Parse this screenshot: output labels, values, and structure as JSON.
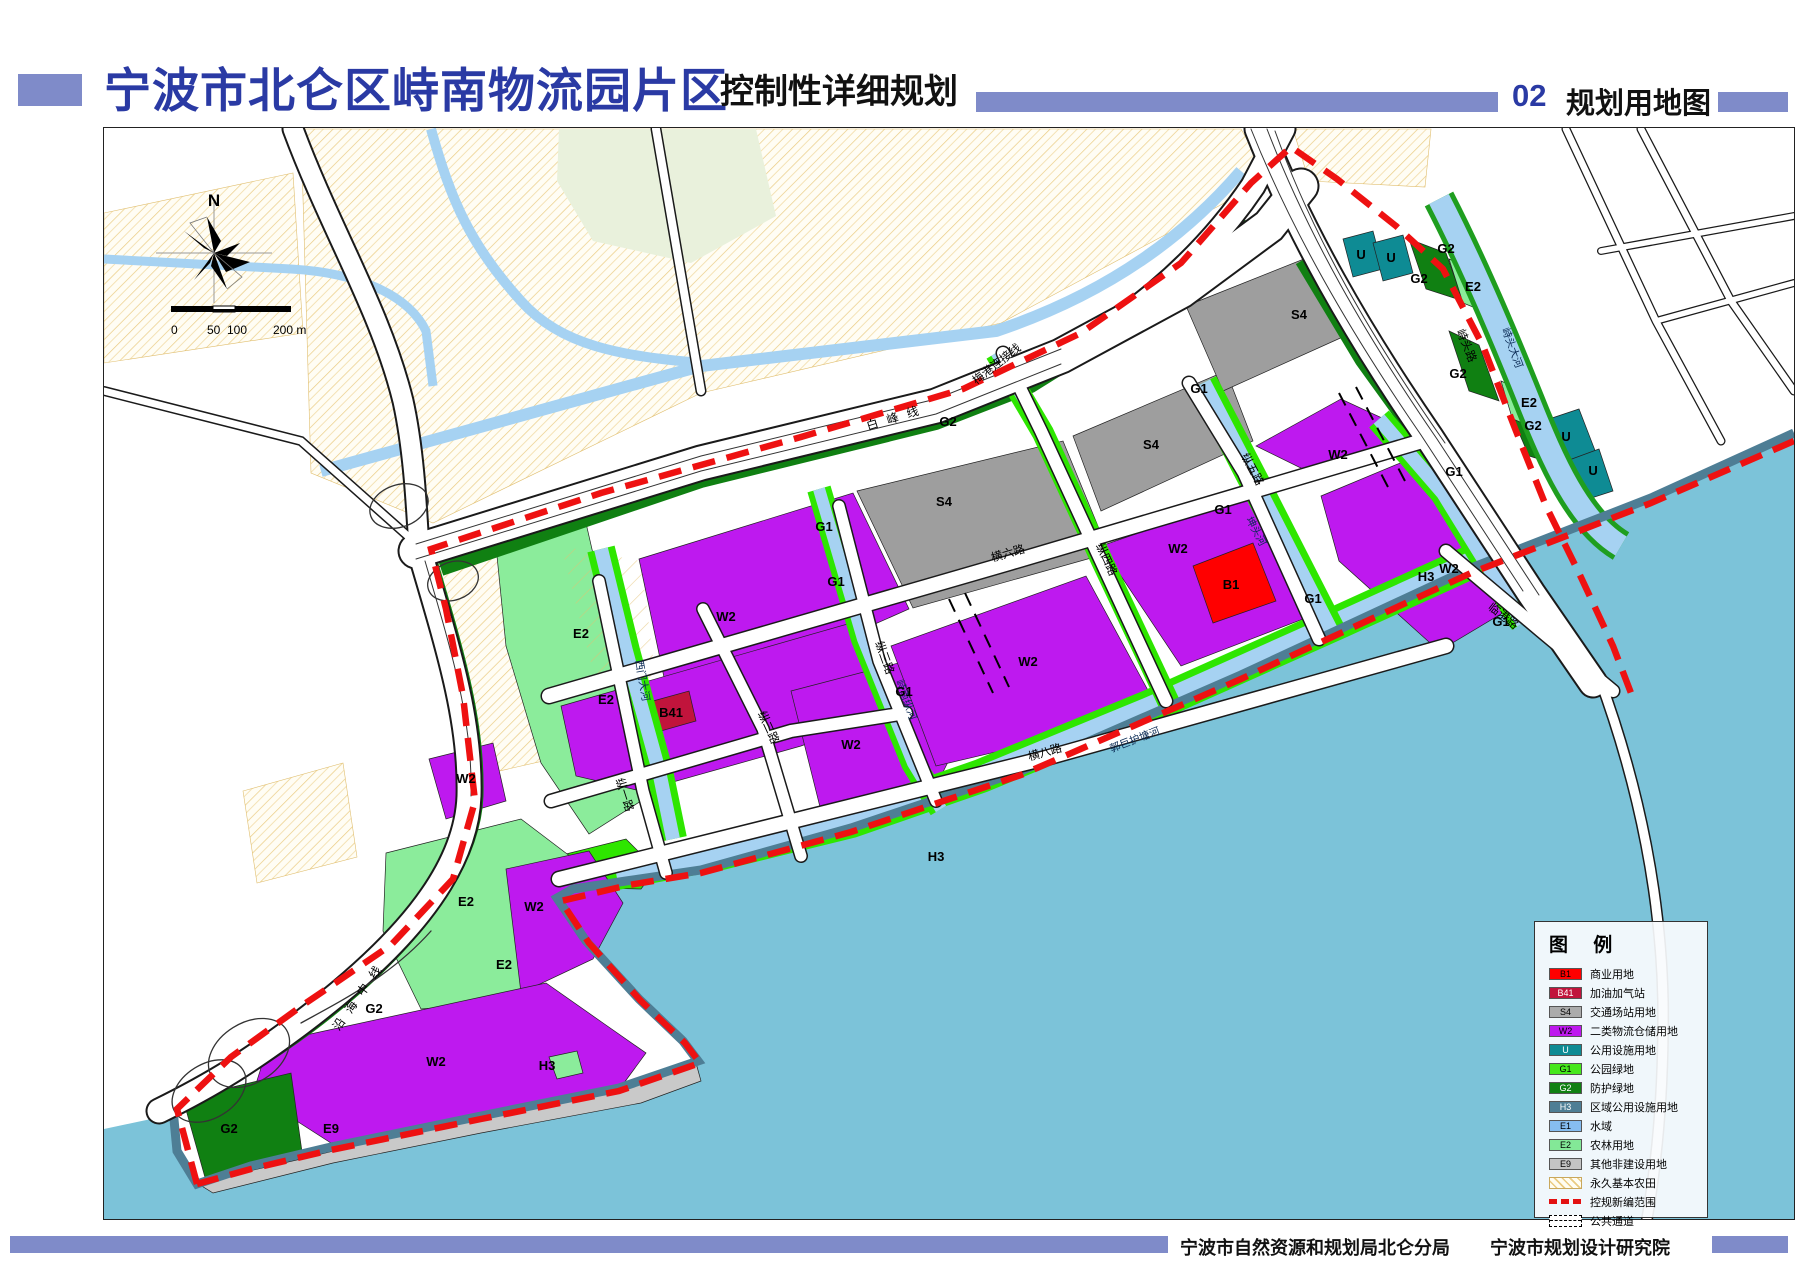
{
  "header": {
    "title": "宁波市北仑区峙南物流园片区",
    "subtitle": "控制性详细规划",
    "chapter_no": "02",
    "chapter_title": "规划用地图"
  },
  "footer": {
    "org1": "宁波市自然资源和规划局北仑分局",
    "org2": "宁波市规划设计研究院"
  },
  "map": {
    "north_label": "N",
    "scalebar": {
      "labels": [
        "0",
        "50",
        "100",
        "200 m"
      ]
    },
    "colors": {
      "B1": "#FF0000",
      "B41": "#C1143C",
      "S4": "#9E9E9E",
      "W2": "#BE19EF",
      "U": "#0E8B94",
      "G1": "#2EE600",
      "G2": "#108012",
      "H3": "#4E7E95",
      "E1": "#A6D2F2",
      "E2": "#8BEC9B",
      "E9": "#C9C9C9",
      "sea": "#7CC3D9",
      "boundary": "#EE1111",
      "hatch_line": "#EACB82",
      "accent": "#7F8BC9",
      "title_blue": "#2A3AA4"
    },
    "legend": {
      "title": "图 例",
      "items": [
        {
          "code": "B1",
          "color": "#FF0000",
          "type": "fill",
          "label": "商业用地"
        },
        {
          "code": "B41",
          "color": "#C1143C",
          "type": "fill-dark",
          "label": "加油加气站"
        },
        {
          "code": "S4",
          "color": "#ABABAB",
          "type": "fill",
          "label": "交通场站用地"
        },
        {
          "code": "W2",
          "color": "#BE19EF",
          "type": "fill",
          "label": "二类物流仓储用地"
        },
        {
          "code": "U",
          "color": "#0E8B94",
          "type": "fill-dark",
          "label": "公用设施用地"
        },
        {
          "code": "G1",
          "color": "#46E81C",
          "type": "fill",
          "label": "公园绿地"
        },
        {
          "code": "G2",
          "color": "#108012",
          "type": "fill-dark",
          "label": "防护绿地"
        },
        {
          "code": "H3",
          "color": "#4E7E95",
          "type": "fill-dark",
          "label": "区域公用设施用地"
        },
        {
          "code": "E1",
          "color": "#86BDF0",
          "type": "fill",
          "label": "水域"
        },
        {
          "code": "E2",
          "color": "#83E897",
          "type": "fill",
          "label": "农林用地"
        },
        {
          "code": "E9",
          "color": "#C4C4C4",
          "type": "fill",
          "label": "其他非建设用地"
        },
        {
          "code": "",
          "color": "",
          "type": "hatch",
          "label": "永久基本农田"
        },
        {
          "code": "",
          "color": "",
          "type": "redline",
          "label": "控规新编范围"
        },
        {
          "code": "",
          "color": "",
          "type": "channel",
          "label": "公共通道"
        }
      ]
    },
    "labels": [
      {
        "t": "白峰线",
        "x": 897,
        "y": 420,
        "r": -17,
        "c": "lb-road-sp"
      },
      {
        "t": "梅港连接线",
        "x": 998,
        "y": 366,
        "r": -38,
        "c": "lb-road"
      },
      {
        "t": "沿海中线",
        "x": 362,
        "y": 996,
        "r": -55,
        "c": "lb-road-sp"
      },
      {
        "t": "横六路",
        "x": 1008,
        "y": 556,
        "r": -16,
        "c": "lb-road"
      },
      {
        "t": "横八路",
        "x": 1045,
        "y": 755,
        "r": -16,
        "c": "lb-road"
      },
      {
        "t": "纵一路",
        "x": 620,
        "y": 795,
        "r": 72,
        "c": "lb-road"
      },
      {
        "t": "纵二路",
        "x": 764,
        "y": 728,
        "r": 65,
        "c": "lb-road"
      },
      {
        "t": "纵三路",
        "x": 880,
        "y": 658,
        "r": 70,
        "c": "lb-road"
      },
      {
        "t": "纵四路",
        "x": 1102,
        "y": 560,
        "r": 65,
        "c": "lb-road"
      },
      {
        "t": "纵五路",
        "x": 1248,
        "y": 470,
        "r": 62,
        "c": "lb-road"
      },
      {
        "t": "峙头路",
        "x": 1462,
        "y": 346,
        "r": 68,
        "c": "lb-road"
      },
      {
        "t": "临港路",
        "x": 1500,
        "y": 618,
        "r": 38,
        "c": "lb-road"
      },
      {
        "t": "西门大河",
        "x": 638,
        "y": 680,
        "r": 80,
        "c": "lb-canal"
      },
      {
        "t": "峙南纵河",
        "x": 902,
        "y": 700,
        "r": 70,
        "c": "lb-canal"
      },
      {
        "t": "坤头河",
        "x": 1252,
        "y": 532,
        "r": 62,
        "c": "lb-canal"
      },
      {
        "t": "郭巨护塘河",
        "x": 1135,
        "y": 742,
        "r": -21,
        "c": "lb-canal"
      },
      {
        "t": "峙头大河",
        "x": 1508,
        "y": 348,
        "r": 70,
        "c": "lb-canal"
      },
      {
        "t": "W2",
        "x": 725,
        "y": 620,
        "r": 0,
        "c": "lb-zone"
      },
      {
        "t": "W2",
        "x": 850,
        "y": 748,
        "r": 0,
        "c": "lb-zone"
      },
      {
        "t": "W2",
        "x": 1027,
        "y": 665,
        "r": 0,
        "c": "lb-zone"
      },
      {
        "t": "W2",
        "x": 1177,
        "y": 552,
        "r": 0,
        "c": "lb-zone"
      },
      {
        "t": "W2",
        "x": 1337,
        "y": 458,
        "r": 0,
        "c": "lb-zone"
      },
      {
        "t": "W2",
        "x": 1448,
        "y": 572,
        "r": 0,
        "c": "lb-zone"
      },
      {
        "t": "W2",
        "x": 533,
        "y": 910,
        "r": 0,
        "c": "lb-zone"
      },
      {
        "t": "W2",
        "x": 435,
        "y": 1065,
        "r": 0,
        "c": "lb-zone"
      },
      {
        "t": "W2",
        "x": 465,
        "y": 782,
        "r": 0,
        "c": "lb-zone"
      },
      {
        "t": "S4",
        "x": 943,
        "y": 505,
        "r": 0,
        "c": "lb-zone"
      },
      {
        "t": "S4",
        "x": 1150,
        "y": 448,
        "r": 0,
        "c": "lb-zone"
      },
      {
        "t": "S4",
        "x": 1298,
        "y": 318,
        "r": 0,
        "c": "lb-zone"
      },
      {
        "t": "B1",
        "x": 1230,
        "y": 588,
        "r": 0,
        "c": "lb-zone"
      },
      {
        "t": "B41",
        "x": 670,
        "y": 716,
        "r": 0,
        "c": "lb-zone"
      },
      {
        "t": "U",
        "x": 1360,
        "y": 258,
        "r": 0,
        "c": "lb-zone"
      },
      {
        "t": "U",
        "x": 1390,
        "y": 261,
        "r": 0,
        "c": "lb-zone"
      },
      {
        "t": "U",
        "x": 1565,
        "y": 440,
        "r": 0,
        "c": "lb-zone"
      },
      {
        "t": "U",
        "x": 1592,
        "y": 474,
        "r": 0,
        "c": "lb-zone"
      },
      {
        "t": "G1",
        "x": 823,
        "y": 530,
        "r": 0,
        "c": "lb-zone"
      },
      {
        "t": "G1",
        "x": 835,
        "y": 585,
        "r": 0,
        "c": "lb-zone"
      },
      {
        "t": "G1",
        "x": 903,
        "y": 695,
        "r": 0,
        "c": "lb-zone"
      },
      {
        "t": "G1",
        "x": 1198,
        "y": 392,
        "r": 0,
        "c": "lb-zone"
      },
      {
        "t": "G1",
        "x": 1222,
        "y": 513,
        "r": 0,
        "c": "lb-zone"
      },
      {
        "t": "G1",
        "x": 1312,
        "y": 602,
        "r": 0,
        "c": "lb-zone"
      },
      {
        "t": "G1",
        "x": 1453,
        "y": 475,
        "r": 0,
        "c": "lb-zone"
      },
      {
        "t": "G1",
        "x": 1500,
        "y": 625,
        "r": 0,
        "c": "lb-zone"
      },
      {
        "t": "G2",
        "x": 947,
        "y": 425,
        "r": 0,
        "c": "lb-zone"
      },
      {
        "t": "G2",
        "x": 1418,
        "y": 282,
        "r": 0,
        "c": "lb-zone"
      },
      {
        "t": "G2",
        "x": 1445,
        "y": 252,
        "r": 0,
        "c": "lb-zone"
      },
      {
        "t": "G2",
        "x": 1457,
        "y": 377,
        "r": 0,
        "c": "lb-zone"
      },
      {
        "t": "G2",
        "x": 1532,
        "y": 429,
        "r": 0,
        "c": "lb-zone"
      },
      {
        "t": "G2",
        "x": 373,
        "y": 1012,
        "r": 0,
        "c": "lb-zone"
      },
      {
        "t": "G2",
        "x": 228,
        "y": 1132,
        "r": 0,
        "c": "lb-zone"
      },
      {
        "t": "E2",
        "x": 580,
        "y": 637,
        "r": 0,
        "c": "lb-zone"
      },
      {
        "t": "E2",
        "x": 605,
        "y": 703,
        "r": 0,
        "c": "lb-zone"
      },
      {
        "t": "E2",
        "x": 465,
        "y": 905,
        "r": 0,
        "c": "lb-zone"
      },
      {
        "t": "E2",
        "x": 503,
        "y": 968,
        "r": 0,
        "c": "lb-zone"
      },
      {
        "t": "E2",
        "x": 1472,
        "y": 290,
        "r": 0,
        "c": "lb-zone"
      },
      {
        "t": "E2",
        "x": 1528,
        "y": 406,
        "r": 0,
        "c": "lb-zone"
      },
      {
        "t": "E9",
        "x": 330,
        "y": 1132,
        "r": 0,
        "c": "lb-zone"
      },
      {
        "t": "H3",
        "x": 935,
        "y": 860,
        "r": 0,
        "c": "lb-zone"
      },
      {
        "t": "H3",
        "x": 546,
        "y": 1069,
        "r": 0,
        "c": "lb-zone"
      },
      {
        "t": "H3",
        "x": 1425,
        "y": 580,
        "r": 0,
        "c": "lb-zone"
      }
    ]
  }
}
